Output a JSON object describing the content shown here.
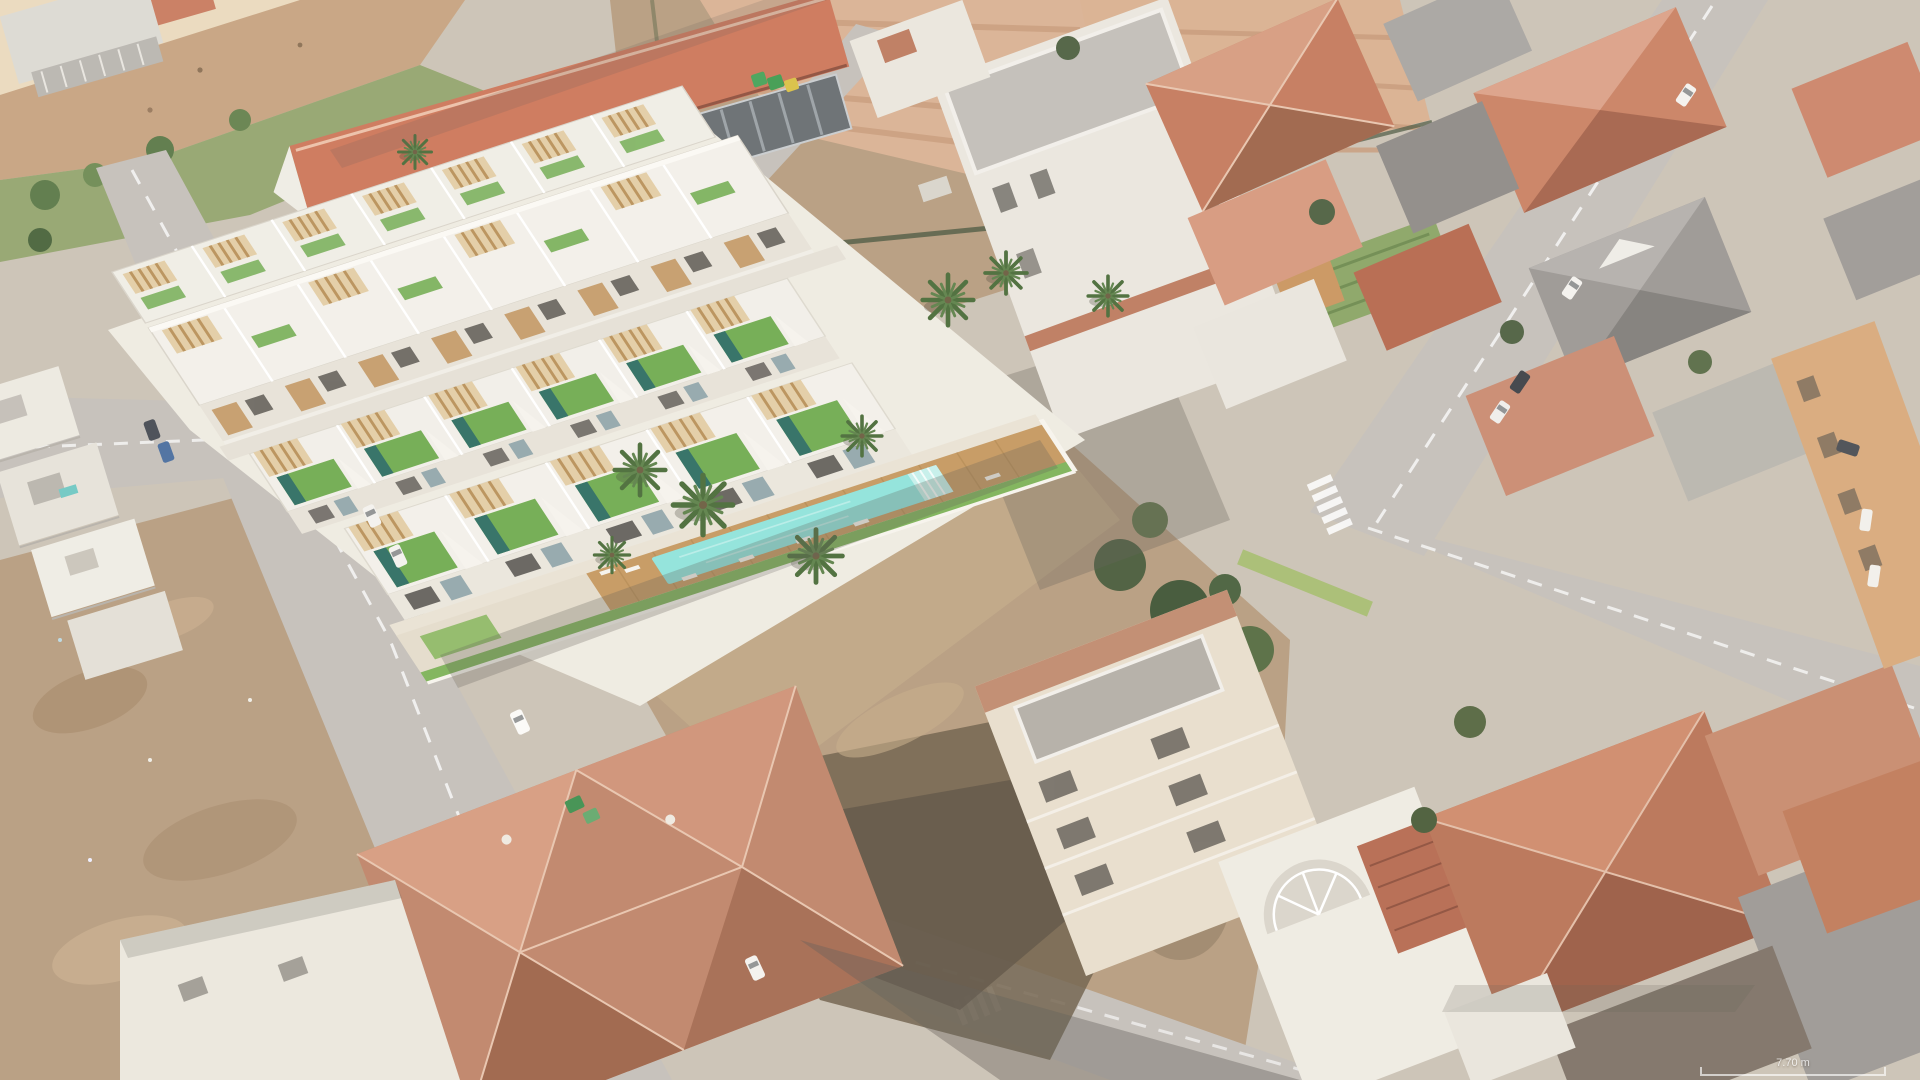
{
  "scene": {
    "scale_indicator": {
      "label": "7.70 m"
    },
    "palette": {
      "sand_beach": "#ead9bd",
      "sand_dark": "#c6a27f",
      "lawn_green": "#94a46e",
      "tree_green": "#5a7846",
      "terracotta": "#cd7658",
      "terracotta_dark": "#9d6347",
      "terracotta_light": "#d69b7e",
      "gray_roof": "#9b9793",
      "asphalt": "#c4bfb9",
      "sidewalk": "#dcd7cf",
      "marking_white": "#ffffff",
      "dirt_light": "#b79c7e",
      "dirt_dark": "#6f5f49",
      "scrub_dark": "#5d5142",
      "render_white": "#f3f0e9",
      "render_facade": "#e7e2d7",
      "wood_pergola": "#e3cda4",
      "wood_slat": "#b99058",
      "deck_wood": "#c5985f",
      "roof_lawn": "#70ab4f",
      "roof_pool": "#2e6e62",
      "communal_pool": "#8fe3da",
      "pool_steps": "#c5f0ea",
      "lawn_bright": "#7db257",
      "palm_green": "#4a6b38",
      "white_wall": "#eceade",
      "cream_wall": "#e8decc",
      "ochre_wall": "#d8a97a",
      "window_dark": "#55514b",
      "glass_blue": "#93a7ab",
      "shadow": "#5f5a52"
    }
  }
}
